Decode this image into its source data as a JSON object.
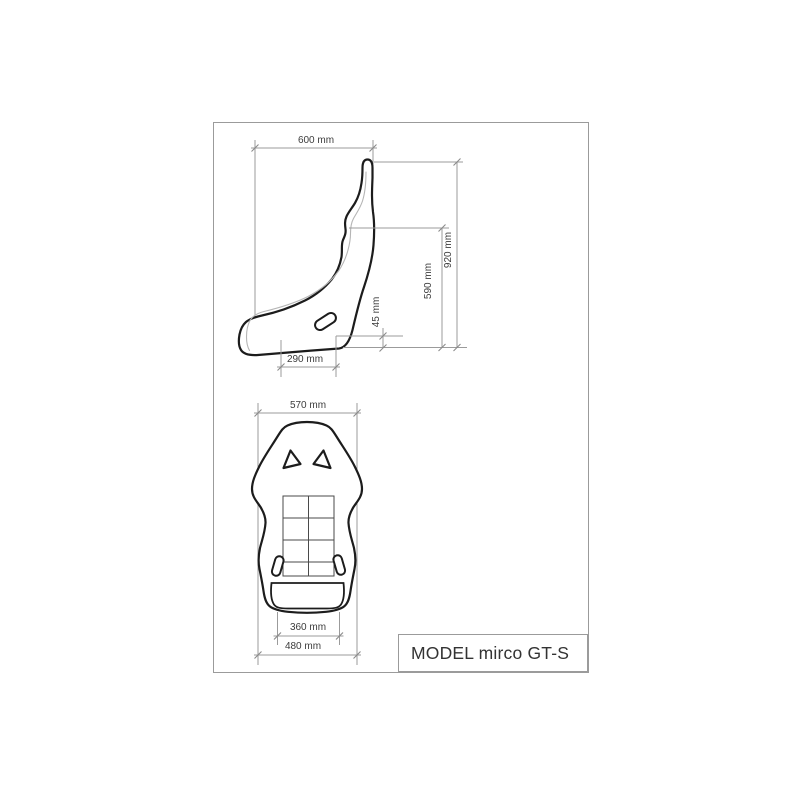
{
  "drawing": {
    "title_block": {
      "model_label": "MODEL mirco GT-S"
    },
    "side_view": {
      "name": "seat-side-profile-view",
      "dims": {
        "overall_depth": "600 mm",
        "overall_height": "920 mm",
        "backrest_height": "590 mm",
        "base_lip_height": "45 mm",
        "cushion_depth": "290 mm"
      }
    },
    "front_view": {
      "name": "seat-front-elevation-view",
      "dims": {
        "shoulder_width": "570 mm",
        "cushion_width": "360 mm",
        "base_width": "480 mm"
      }
    },
    "colors": {
      "outline": "#1c1c1c",
      "inner_line": "#b5b5b5",
      "detail_line": "#4a4a4a",
      "dimension_line": "#9b9b9b",
      "tick": "#8a8a8a",
      "dim_text": "#3c3c3c",
      "frame_border": "#9b9b9b",
      "title_text": "#333333"
    }
  }
}
